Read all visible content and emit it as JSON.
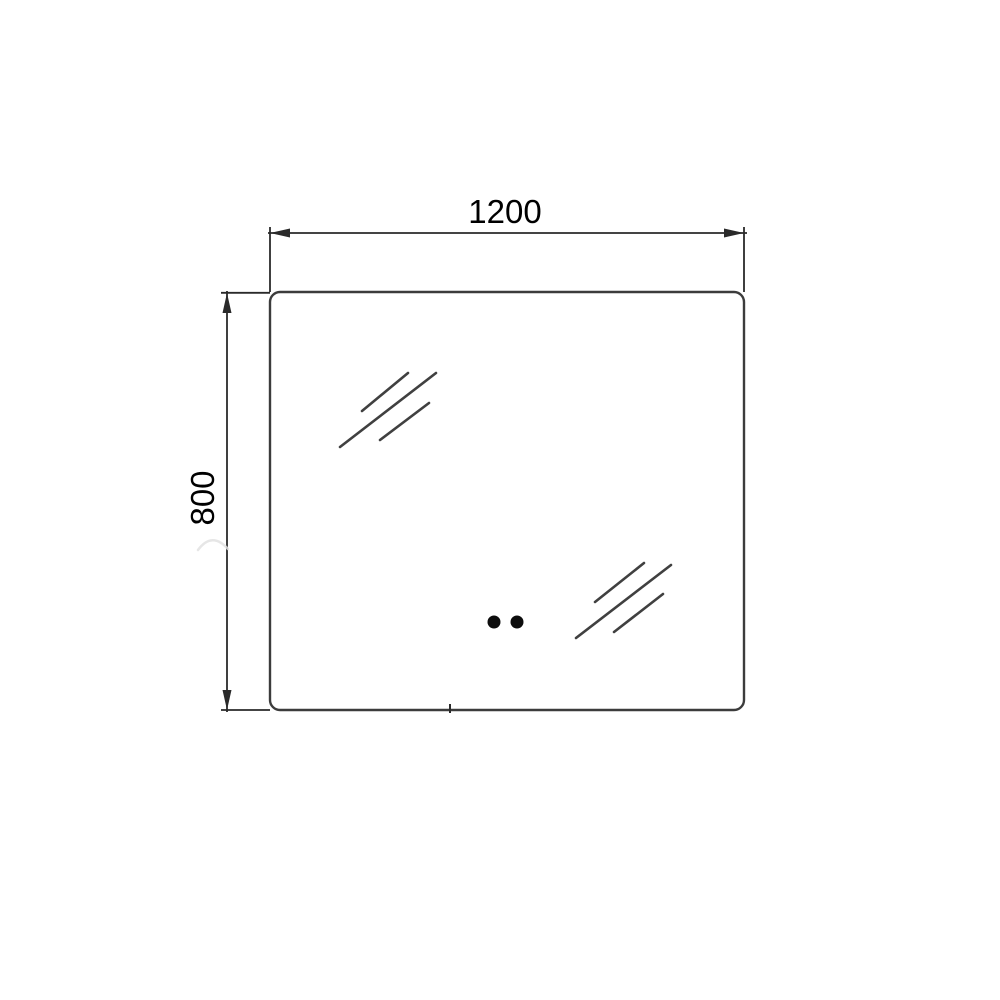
{
  "drawing": {
    "dimensions": {
      "width": {
        "label": "1200"
      },
      "height": {
        "label": "800"
      }
    },
    "colors": {
      "background": "#ffffff",
      "outline": "#3c3c3c",
      "dimension": "#2a2a2a",
      "text": "#000000",
      "sensor_dot": "#0d0d0d",
      "glare": "#404040",
      "faint_mark": "#e2e2e2"
    },
    "features": {
      "touch_sensor_dots": "2",
      "glare_hatch_groups": "2"
    }
  }
}
